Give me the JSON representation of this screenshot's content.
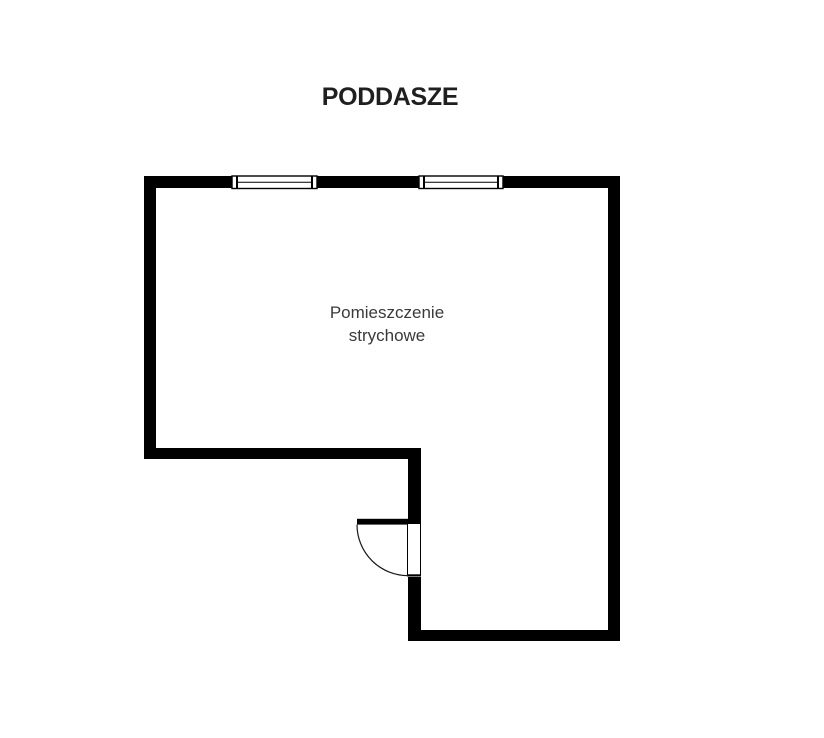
{
  "page": {
    "background": "#ffffff"
  },
  "header": {
    "title": "PODDASZE"
  },
  "plan": {
    "room_label": {
      "line1": "Pomieszczenie",
      "line2": "strychowe"
    },
    "features": {
      "windows": [
        "window-top-left",
        "window-top-right"
      ],
      "door": "door-bottom-middle-with-swing-arc"
    }
  },
  "colors": {
    "wall": "#000000",
    "window_fill": "#ffffff",
    "window_frame": "#000000",
    "door_leaf": "#000000",
    "door_arc": "#1a1a1a",
    "title_text": "#1f1f1f",
    "room_label_text": "#3a3a3a"
  }
}
